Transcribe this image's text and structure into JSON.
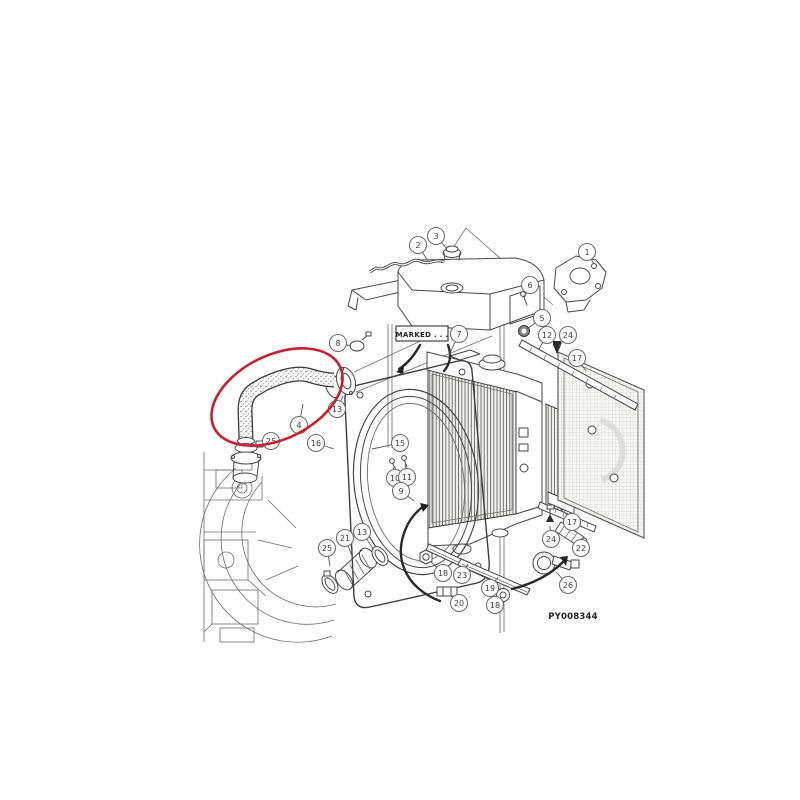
{
  "figure": {
    "type": "exploded-parts-diagram",
    "subject": "radiator-and-cooling-assembly",
    "image_code": "PY008344",
    "marked_label": "MARKED . . .",
    "highlight_color": "#cc1f2d",
    "line_color": "#474747",
    "background": "#ffffff"
  },
  "highlight_ellipse": {
    "cx": 277,
    "cy": 397,
    "rx": 70,
    "ry": 42,
    "rotate": -26
  },
  "callouts": [
    {
      "label": "1",
      "x": 587,
      "y": 252,
      "tx": 594,
      "ty": 264
    },
    {
      "label": "2",
      "x": 418,
      "y": 245,
      "tx": 428,
      "ty": 261
    },
    {
      "label": "3",
      "x": 436,
      "y": 236,
      "tx": 447,
      "ty": 249
    },
    {
      "label": "6",
      "x": 530,
      "y": 285,
      "tx": 524,
      "ty": 298
    },
    {
      "label": "7",
      "x": 459,
      "y": 334,
      "tx": 449,
      "ty": 355
    },
    {
      "label": "8",
      "x": 338,
      "y": 343,
      "tx": 351,
      "ty": 346
    },
    {
      "label": "5",
      "x": 542,
      "y": 318,
      "tx": 527,
      "ty": 329
    },
    {
      "label": "12",
      "x": 547,
      "y": 335,
      "tx": 539,
      "ty": 349
    },
    {
      "label": "24",
      "x": 568,
      "y": 335,
      "tx": 559,
      "ty": 346
    },
    {
      "label": "17",
      "x": 577,
      "y": 358,
      "tx": 586,
      "ty": 371
    },
    {
      "label": "13",
      "x": 337,
      "y": 409,
      "tx": 343,
      "ty": 396
    },
    {
      "label": "4",
      "x": 299,
      "y": 425,
      "tx": 303,
      "ty": 404
    },
    {
      "label": "25",
      "x": 271,
      "y": 441,
      "tx": 256,
      "ty": 447
    },
    {
      "label": "16",
      "x": 316,
      "y": 443,
      "tx": 334,
      "ty": 449
    },
    {
      "label": "15",
      "x": 400,
      "y": 443,
      "tx": 372,
      "ty": 449
    },
    {
      "label": "10",
      "x": 395,
      "y": 478,
      "tx": 393,
      "ty": 467
    },
    {
      "label": "11",
      "x": 407,
      "y": 477,
      "tx": 405,
      "ty": 464
    },
    {
      "label": "9",
      "x": 401,
      "y": 491,
      "tx": 414,
      "ty": 501
    },
    {
      "label": "25",
      "x": 327,
      "y": 548,
      "tx": 330,
      "ty": 566
    },
    {
      "label": "21",
      "x": 345,
      "y": 538,
      "tx": 352,
      "ty": 556
    },
    {
      "label": "13",
      "x": 362,
      "y": 532,
      "tx": 374,
      "ty": 550
    },
    {
      "label": "18",
      "x": 443,
      "y": 573,
      "tx": 431,
      "ty": 562
    },
    {
      "label": "23",
      "x": 462,
      "y": 575,
      "tx": 468,
      "ty": 564
    },
    {
      "label": "19",
      "x": 490,
      "y": 588,
      "tx": 498,
      "ty": 577
    },
    {
      "label": "20",
      "x": 459,
      "y": 603,
      "tx": 451,
      "ty": 596
    },
    {
      "label": "18",
      "x": 495,
      "y": 605,
      "tx": 501,
      "ty": 599
    },
    {
      "label": "17",
      "x": 572,
      "y": 522,
      "tx": 564,
      "ty": 511
    },
    {
      "label": "24",
      "x": 551,
      "y": 539,
      "tx": 550,
      "ty": 526
    },
    {
      "label": "22",
      "x": 581,
      "y": 548,
      "tx": 577,
      "ty": 540
    },
    {
      "label": "26",
      "x": 568,
      "y": 585,
      "tx": 556,
      "ty": 572
    }
  ]
}
